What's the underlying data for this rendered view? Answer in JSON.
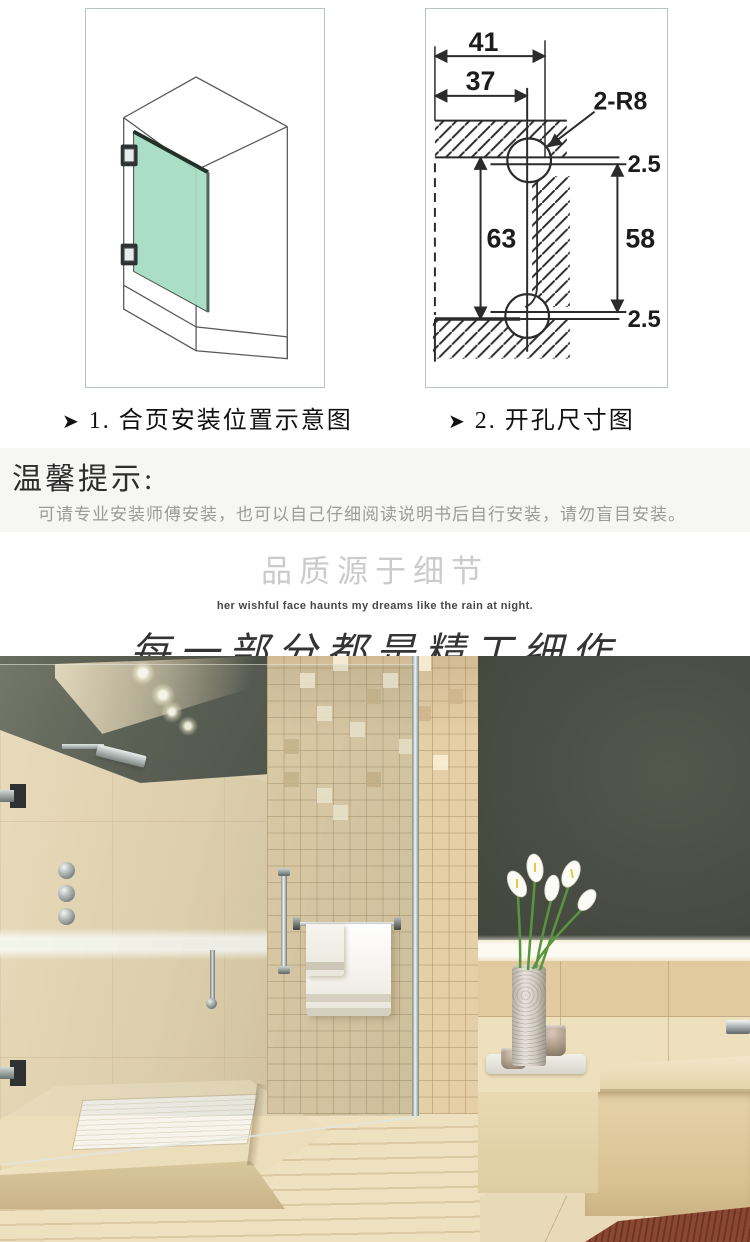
{
  "diagrams": {
    "panel1": {
      "marker": "➤",
      "caption": "1. 合页安装位置示意图"
    },
    "panel2": {
      "marker": "➤",
      "caption": "2. 开孔尺寸图",
      "dims": {
        "width_outer": "41",
        "width_inner": "37",
        "radius_callout": "2-R8",
        "offset_top": "2.5",
        "height_center": "63",
        "height_side": "58",
        "offset_bottom": "2.5"
      }
    }
  },
  "notice": {
    "title": "温馨提示:",
    "body": "可请专业安装师傅安装，也可以自己仔细阅读说明书后自行安装，请勿盲目安装。"
  },
  "slogan": {
    "heading": "品质源于细节",
    "subheading": "her wishful face haunts my dreams like the rain at night.",
    "calligraphy": "每一部分都是精工细作"
  },
  "colors": {
    "door_glass_green": "#a5dcc4",
    "notice_background": "#f6f6f5",
    "wall_beige": "#e9d9b8",
    "wall_charcoal": "#44473e",
    "mosaic_tan": "#e4cfa7",
    "mat_redwood": "#8a4732",
    "line_ink": "#2b2b2b"
  }
}
